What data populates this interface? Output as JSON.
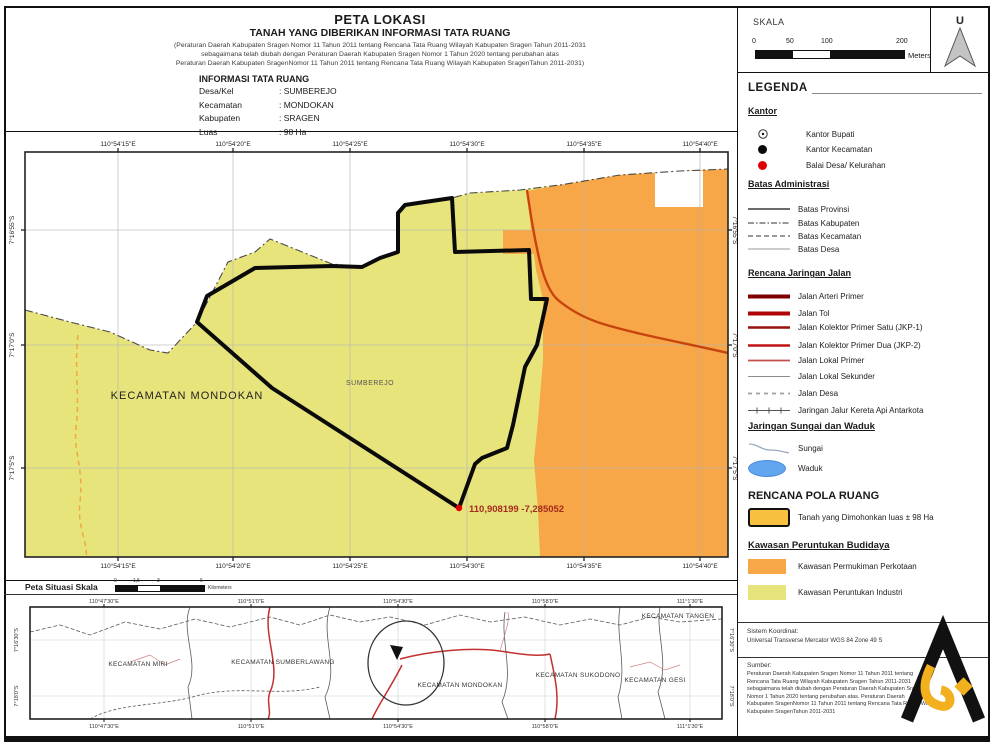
{
  "title_block": {
    "title": "PETA LOKASI",
    "subtitle": "TANAH YANG DIBERIKAN INFORMASI TATA RUANG",
    "regulation_lines": [
      "(Peraturan Daerah Kabupaten Sragen Nomor 11 Tahun 2011 tentang Rencana Tata Ruang Wilayah Kabupaten Sragen Tahun 2011-2031",
      "sebagaimana telah diubah dengan Peraturan Daerah Kabupaten Sragen Nomor 1 Tahun 2020 tentang perubahan atas",
      "Peraturan Daerah Kabupaten SragenNomor 11 Tahun 2011 tentang Rencana Tata Ruang Wilayah Kabupaten SragenTahun 2011-2031)"
    ],
    "info_header": "INFORMASI TATA RUANG",
    "info_rows": [
      {
        "label": "Desa/Kel",
        "value": ": SUMBEREJO"
      },
      {
        "label": "Kecamatan",
        "value": ": MONDOKAN"
      },
      {
        "label": "Kabupaten",
        "value": ": SRAGEN"
      },
      {
        "label": "Luas",
        "value": ": 98 Ha"
      }
    ]
  },
  "scale_box": {
    "label": "SKALA",
    "ticks": [
      "0",
      "50",
      "100",
      "200"
    ],
    "unit": "Meters",
    "north_label": "U"
  },
  "legend": {
    "title": "LEGENDA",
    "kantor": {
      "heading": "Kantor",
      "items": [
        "Kantor Bupati",
        "Kantor Kecamatan",
        "Balai Desa/ Kelurahan"
      ]
    },
    "batas": {
      "heading": "Batas Administrasi",
      "items": [
        "Batas Provinsi",
        "Batas Kabupaten",
        "Batas Kecamatan",
        "Batas Desa"
      ]
    },
    "jalan": {
      "heading": "Rencana Jaringan Jalan",
      "items": [
        "Jalan Arteri Primer",
        "Jalan Tol",
        "Jalan Kolektor Primer Satu (JKP-1)",
        "Jalan Kolektor Primer Dua (JKP-2)",
        "Jalan Lokal Primer",
        "Jalan Lokal Sekunder",
        "Jalan Desa",
        "Jaringan Jalur Kereta Api Antarkota"
      ]
    },
    "sungai": {
      "heading": "Jaringan Sungai dan Waduk",
      "items": [
        "Sungai",
        "Waduk"
      ]
    },
    "pola_ruang": {
      "heading": "RENCANA POLA RUANG",
      "item": "Tanah yang Dimohonkan luas ± 98 Ha"
    },
    "budidaya": {
      "heading": "Kawasan Peruntukan Budidaya",
      "items": [
        "Kawasan Permukiman Perkotaan",
        "Kawasan Peruntukan Industri"
      ]
    }
  },
  "map": {
    "x_labels": [
      "110°54'15\"E",
      "110°54'20\"E",
      "110°54'25\"E",
      "110°54'30\"E",
      "110°54'35\"E",
      "110°54'40\"E"
    ],
    "y_labels": [
      "7°16'55\"S",
      "7°17'0\"S",
      "7°17'5\"S"
    ],
    "kecamatan_label": "KECAMATAN MONDOKAN",
    "desa_label": "SUMBEREJO",
    "point_label": "110,908199  -7,285052"
  },
  "situasi": {
    "header": "Peta Situasi Skala",
    "x_labels": [
      "110°47'30\"E",
      "110°51'0\"E",
      "110°54'30\"E",
      "110°58'0\"E",
      "111°1'30\"E"
    ],
    "y_labels": [
      "7°16'30\"S",
      "7°18'0\"S"
    ],
    "kecamatan_labels": [
      "KECAMATAN MIRI",
      "KECAMATAN SUMBERLAWANG",
      "KECAMATAN MONDOKAN",
      "KECAMATAN SUKODONO",
      "KECAMATAN GESI",
      "KECAMATAN TANGEN"
    ],
    "scale_ticks": [
      "0",
      "1,5",
      "3",
      "6"
    ],
    "scale_unit": "Kilometers"
  },
  "footer": {
    "koordinat_label": "Sistem Koordinat:",
    "koordinat_value": "Universal Transverse Mercator WGS 84 Zone 49 S",
    "sumber_label": "Sumber:",
    "sumber_lines": [
      "Peraturan Daerah Kabupaten Sragen Nomor 11 Tahun 2011 tentang",
      "Rencana Tata Ruang Wilayah Kabupaten Sragen Tahun 2011-2031",
      "sebagaimana telah diubah dengan Peraturan Daerah Kabupaten Sragen",
      "Nomor 1 Tahun 2020 tentang perubahan atas. Peraturan Daerah",
      "Kabupaten SragenNomor 11 Tahun 2011 tentang Rencana Tata Ruang Wilayah",
      "Kabupaten SragenTahun 2011-2031"
    ]
  },
  "colors": {
    "industri": "#e8e47c",
    "permukiman": "#f7a648",
    "tanah_dimohonkan": "#f7c03e",
    "waduk": "#63a6f0",
    "point": "#e80000",
    "road_major": "#c8440e"
  }
}
